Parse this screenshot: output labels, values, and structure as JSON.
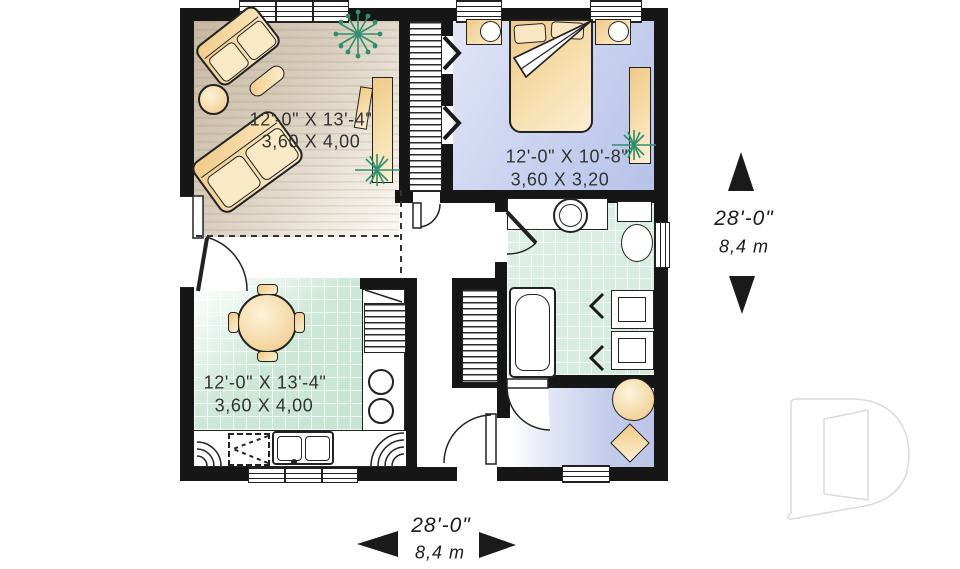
{
  "rooms": {
    "living": {
      "imperial": "12'-0\" X 13'-4\"",
      "metric": "3,60 X 4,00"
    },
    "bedroom": {
      "imperial": "12'-0\" X 10'-8\"",
      "metric": "3,60 X 3,20"
    },
    "kitchen": {
      "imperial": "12'-0\" X 13'-4\"",
      "metric": "3,60 X 4,00"
    }
  },
  "dimensions": {
    "right": {
      "imperial": "28'-0\"",
      "metric": "8,4 m"
    },
    "bottom": {
      "imperial": "28'-0\"",
      "metric": "8,4 m"
    }
  },
  "icons": {
    "dimension_arrow_up": "▲",
    "dimension_arrow_down": "▼",
    "dimension_arrow_left": "◀",
    "dimension_arrow_right": "▶",
    "plant": "✳",
    "logo_watermark_letter": "D"
  },
  "colors": {
    "wall": "#161616",
    "living_floor": "#d5c8b6",
    "bedroom_floor": "#c0c9ea",
    "kitchen_floor": "#cfe8da",
    "bath_floor": "#d6ecdf",
    "den_floor": "#c6cdeb",
    "furniture": "#f3d49a",
    "plant_green": "#2d8f6f",
    "logo_outline": "#dadada"
  }
}
